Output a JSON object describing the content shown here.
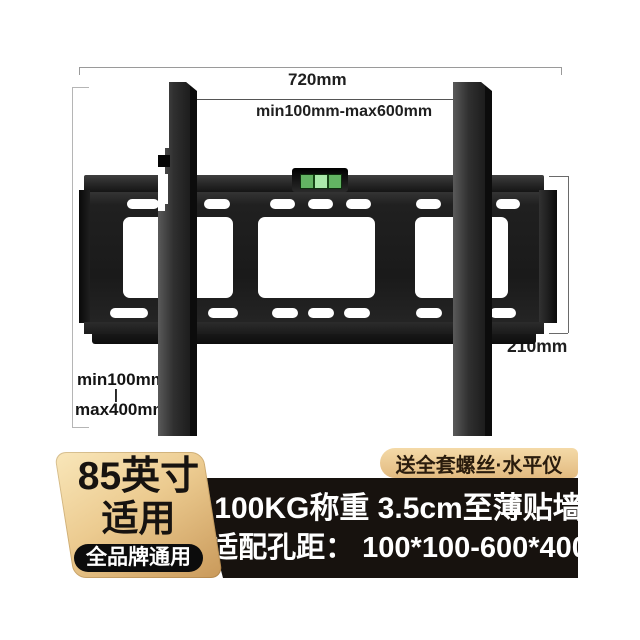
{
  "product": {
    "description": "TV wall mount bracket with bubble level"
  },
  "dimensions": {
    "top_width": "720mm",
    "hole_width_range": "min100mm-max600mm",
    "plate_height": "210mm",
    "vertical_min": "min100mm",
    "vertical_separator": "|",
    "vertical_max": "max400mm"
  },
  "badges": {
    "size": {
      "line1": "85英寸",
      "line2": "适用",
      "sub": "全品牌通用"
    },
    "gift": "送全套螺丝·水平仪"
  },
  "banner": {
    "line1": "100KG称重 3.5cm至薄贴墙",
    "line2": "适配孔距： 100*100-600*400"
  },
  "colors": {
    "badge_gold_light": "#f9e7ba",
    "badge_gold_dark": "#c9995a",
    "banner_black": "#17120e",
    "level_green": "#aaeaaa",
    "metal_dark": "#1d1d1d",
    "text_white": "#ffffff"
  }
}
